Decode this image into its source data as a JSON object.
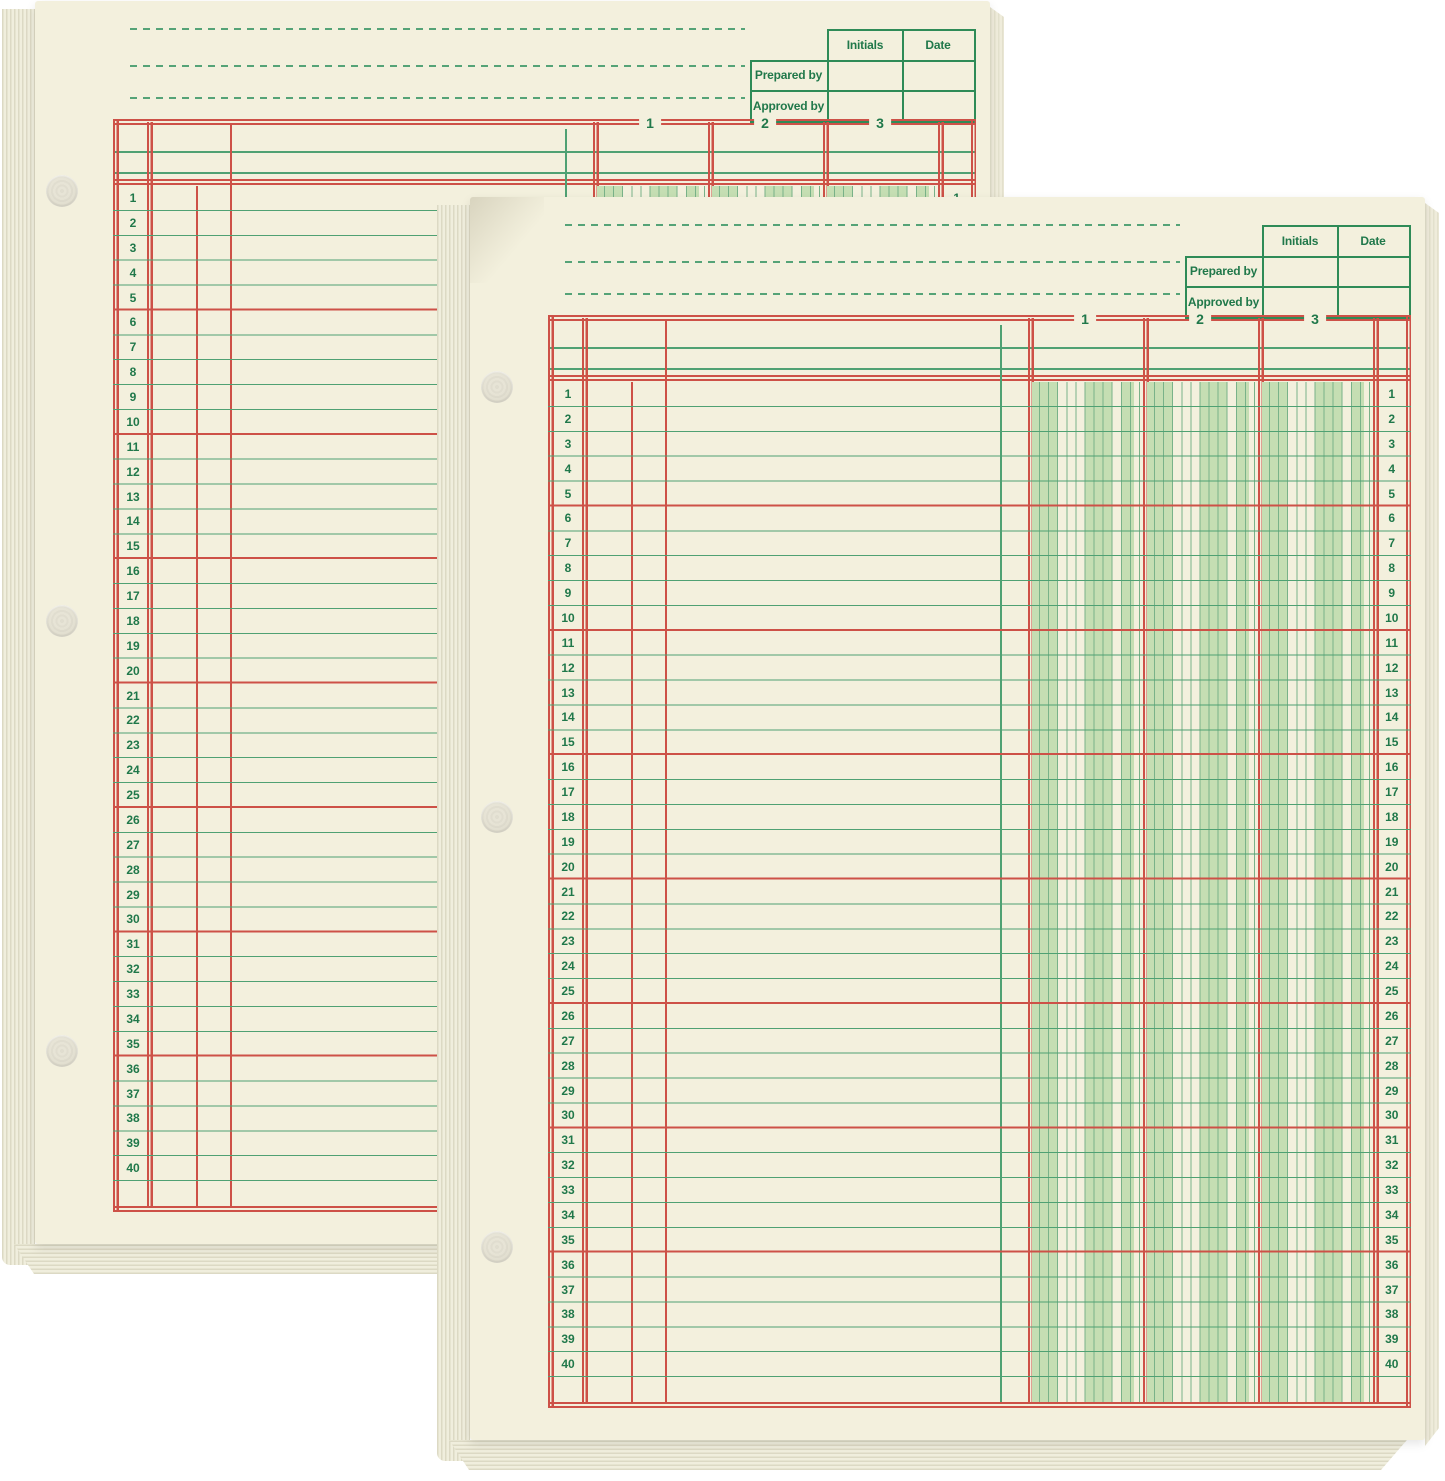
{
  "page": {
    "background": "#ffffff",
    "description_labels": {}
  },
  "sheet": {
    "approval_table": {
      "col_initials": "Initials",
      "col_date": "Date",
      "row_prepared": "Prepared by",
      "row_approved": "Approved by"
    },
    "column_headers": [
      "1",
      "2",
      "3"
    ],
    "row_numbers": [
      1,
      2,
      3,
      4,
      5,
      6,
      7,
      8,
      9,
      10,
      11,
      12,
      13,
      14,
      15,
      16,
      17,
      18,
      19,
      20,
      21,
      22,
      23,
      24,
      25,
      26,
      27,
      28,
      29,
      30,
      31,
      32,
      33,
      34,
      35,
      36,
      37,
      38,
      39,
      40
    ],
    "colors": {
      "paper": "#f3f0dd",
      "green_line": "#4fa173",
      "green_text": "#20784a",
      "red_line": "#cd5147",
      "stripe_fill": "#c5deb3",
      "stripe_line": "#79b289",
      "table_border": "#2e8b57",
      "dash_green": "#55a377",
      "stack_edge": "#dcd9c4",
      "hole_fill": "#e7e4d6"
    }
  }
}
